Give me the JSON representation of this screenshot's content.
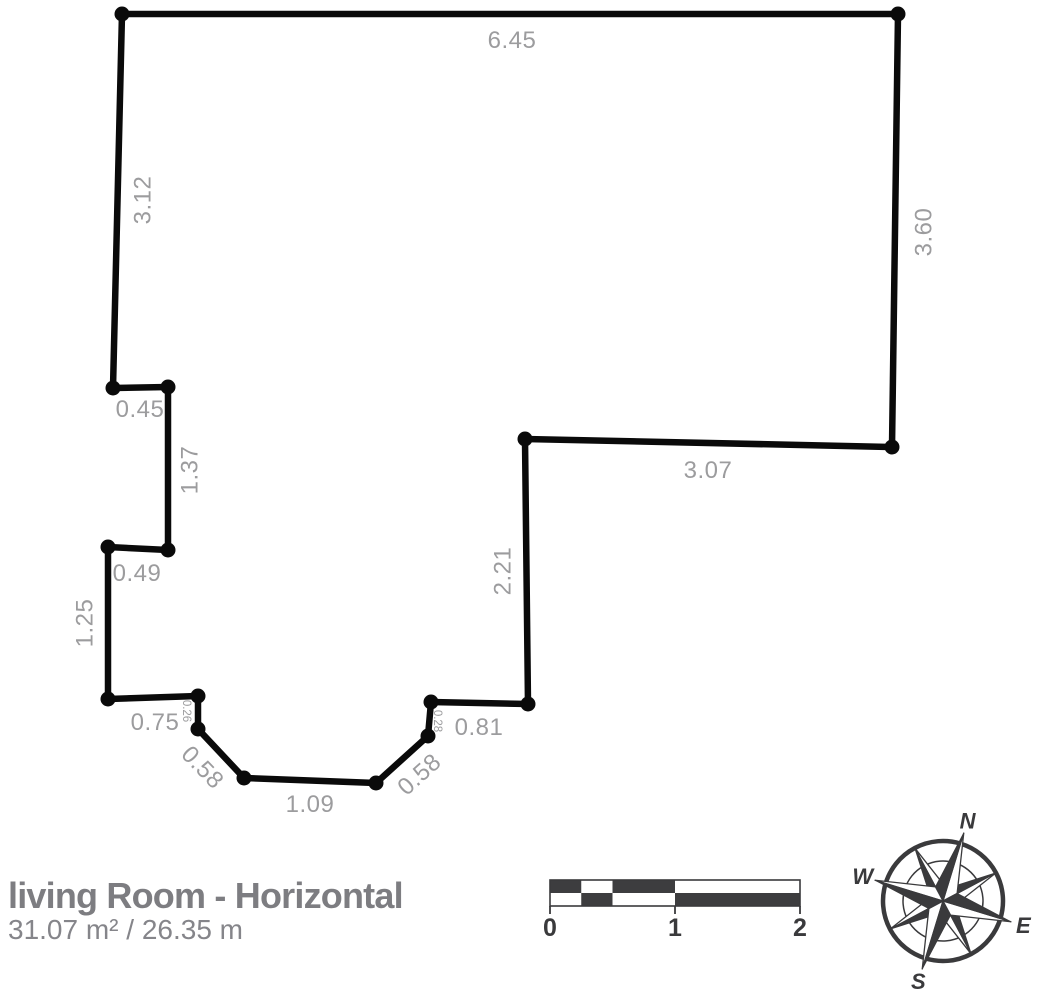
{
  "plan": {
    "dims": [
      {
        "wall": "top",
        "value": "6.45"
      },
      {
        "wall": "right",
        "value": "3.60"
      },
      {
        "wall": "upper-inner",
        "value": "3.07"
      },
      {
        "wall": "inner-vertical",
        "value": "2.21"
      },
      {
        "wall": "bottom-right",
        "value": "0.81"
      },
      {
        "wall": "notch-right",
        "value": "0.28"
      },
      {
        "wall": "diagonal-right",
        "value": "0.58"
      },
      {
        "wall": "bottom",
        "value": "1.09"
      },
      {
        "wall": "diagonal-left",
        "value": "0.58"
      },
      {
        "wall": "notch-left",
        "value": "0.26"
      },
      {
        "wall": "bottom-left",
        "value": "0.75"
      },
      {
        "wall": "left-lower",
        "value": "1.25"
      },
      {
        "wall": "step-lower",
        "value": "0.49"
      },
      {
        "wall": "left-middle",
        "value": "1.37"
      },
      {
        "wall": "step-upper",
        "value": "0.45"
      },
      {
        "wall": "left-upper",
        "value": "3.12"
      }
    ]
  },
  "footer": {
    "title": "living Room - Horizontal",
    "metrics": "31.07 m² / 26.35 m"
  },
  "scalebar": {
    "labels": [
      "0",
      "1",
      "2"
    ]
  },
  "compass": {
    "n": "N",
    "e": "E",
    "s": "S",
    "w": "W"
  },
  "colors": {
    "wall": "#0a0a0a",
    "dim_label": "#9c9c9e",
    "title_text": "#7d7d81",
    "scale_and_compass": "#3a3a3c",
    "background": "#ffffff"
  }
}
